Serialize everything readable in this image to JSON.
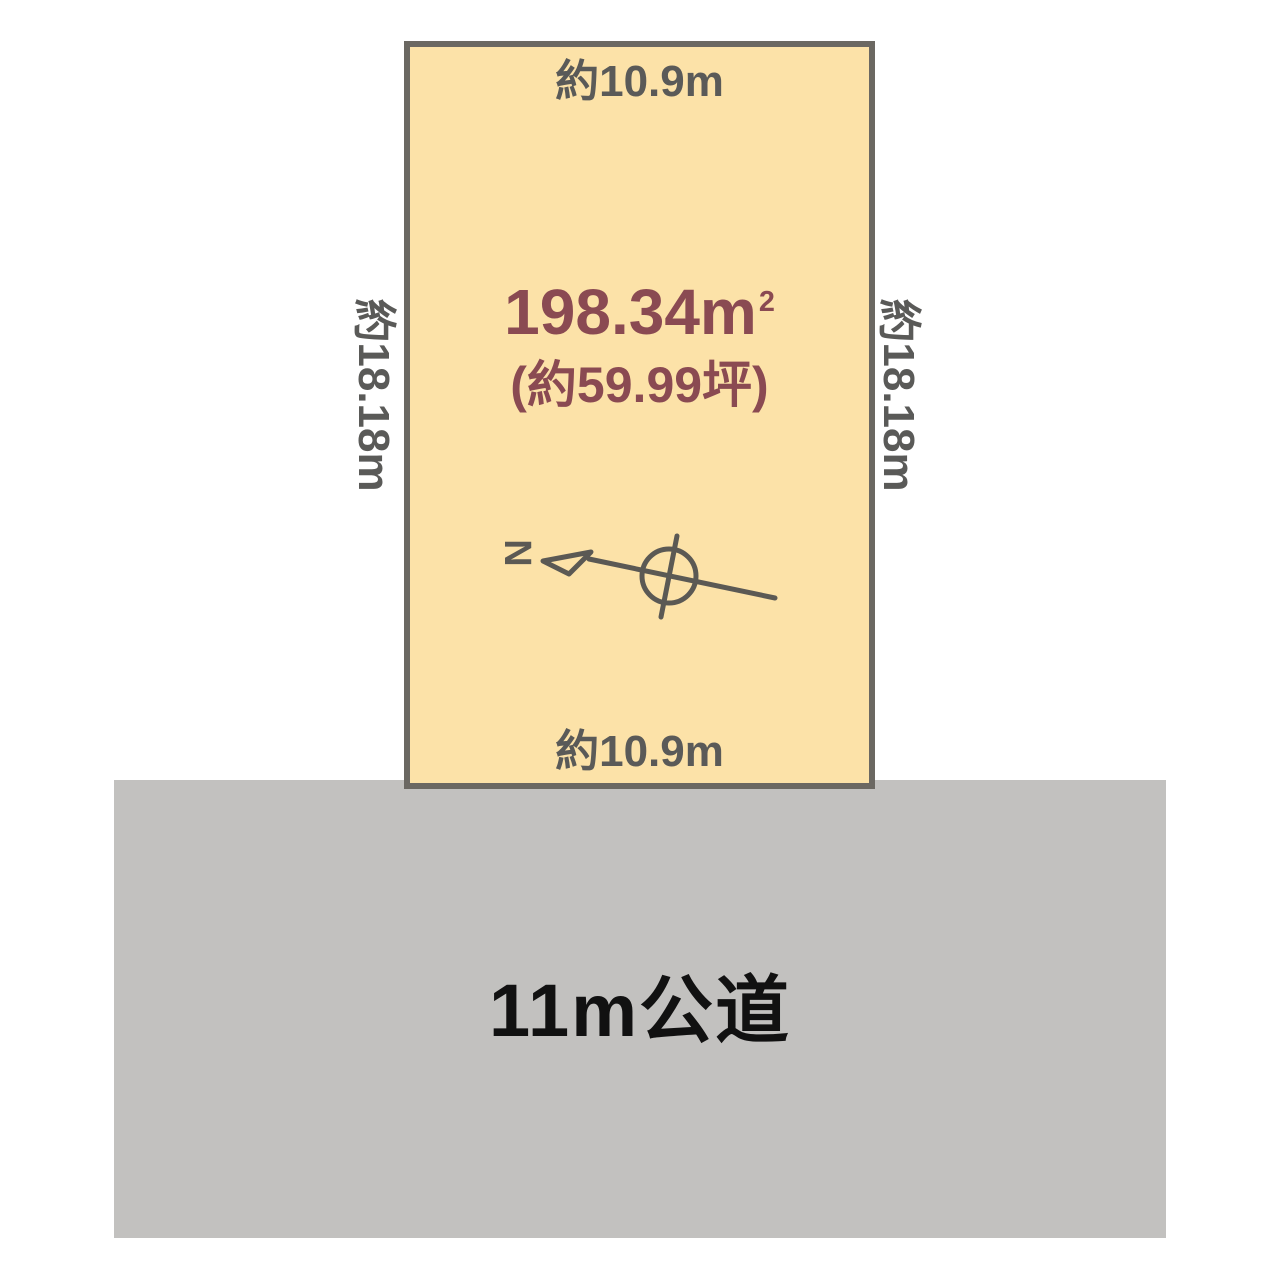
{
  "plot": {
    "area_m2": "198.34m",
    "area_m2_sup": "2",
    "area_tsubo": "(約59.99坪)",
    "top_dimension": "約10.9m",
    "bottom_dimension": "約10.9m",
    "left_dimension": "約18.18m",
    "right_dimension": "約18.18m",
    "fill_color": "#FCE2A8",
    "border_color": "#6B6862",
    "area_text_color": "#8A4A52",
    "dimension_text_color": "#5A5A58"
  },
  "road": {
    "label": "11m公道",
    "fill_color": "#C2C1BF",
    "text_color": "#111111"
  },
  "compass": {
    "north_label": "N",
    "stroke_color": "#5B5954"
  }
}
